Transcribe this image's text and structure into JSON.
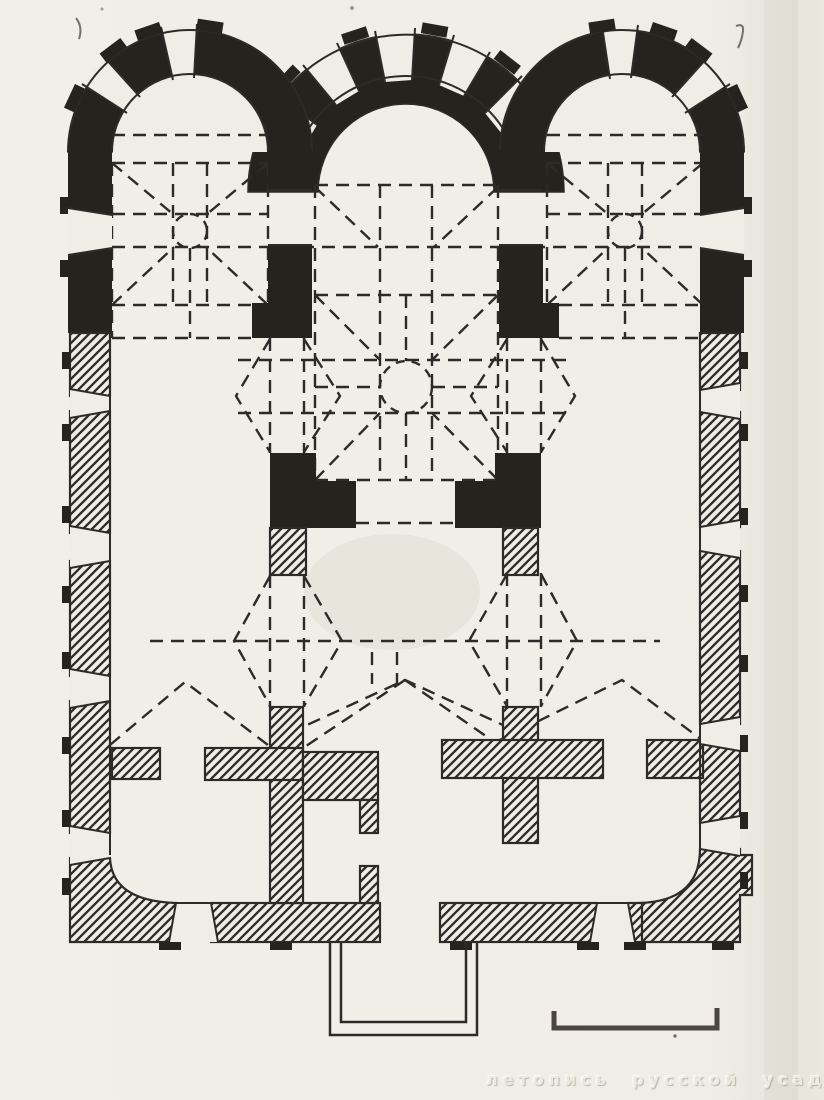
{
  "figure": {
    "type": "scanned floor plan of a three-apse church, solid black and hatched masonry with dashed vault projections",
    "watermark": "летопись русской усадьбы",
    "scale_bar": "unlabeled graphic scale bar at lower right"
  },
  "palette": {
    "paper": "#efede6",
    "ink_black": "#26231f",
    "ink_line": "#2c2b28",
    "watermark_text": "#eceade"
  }
}
